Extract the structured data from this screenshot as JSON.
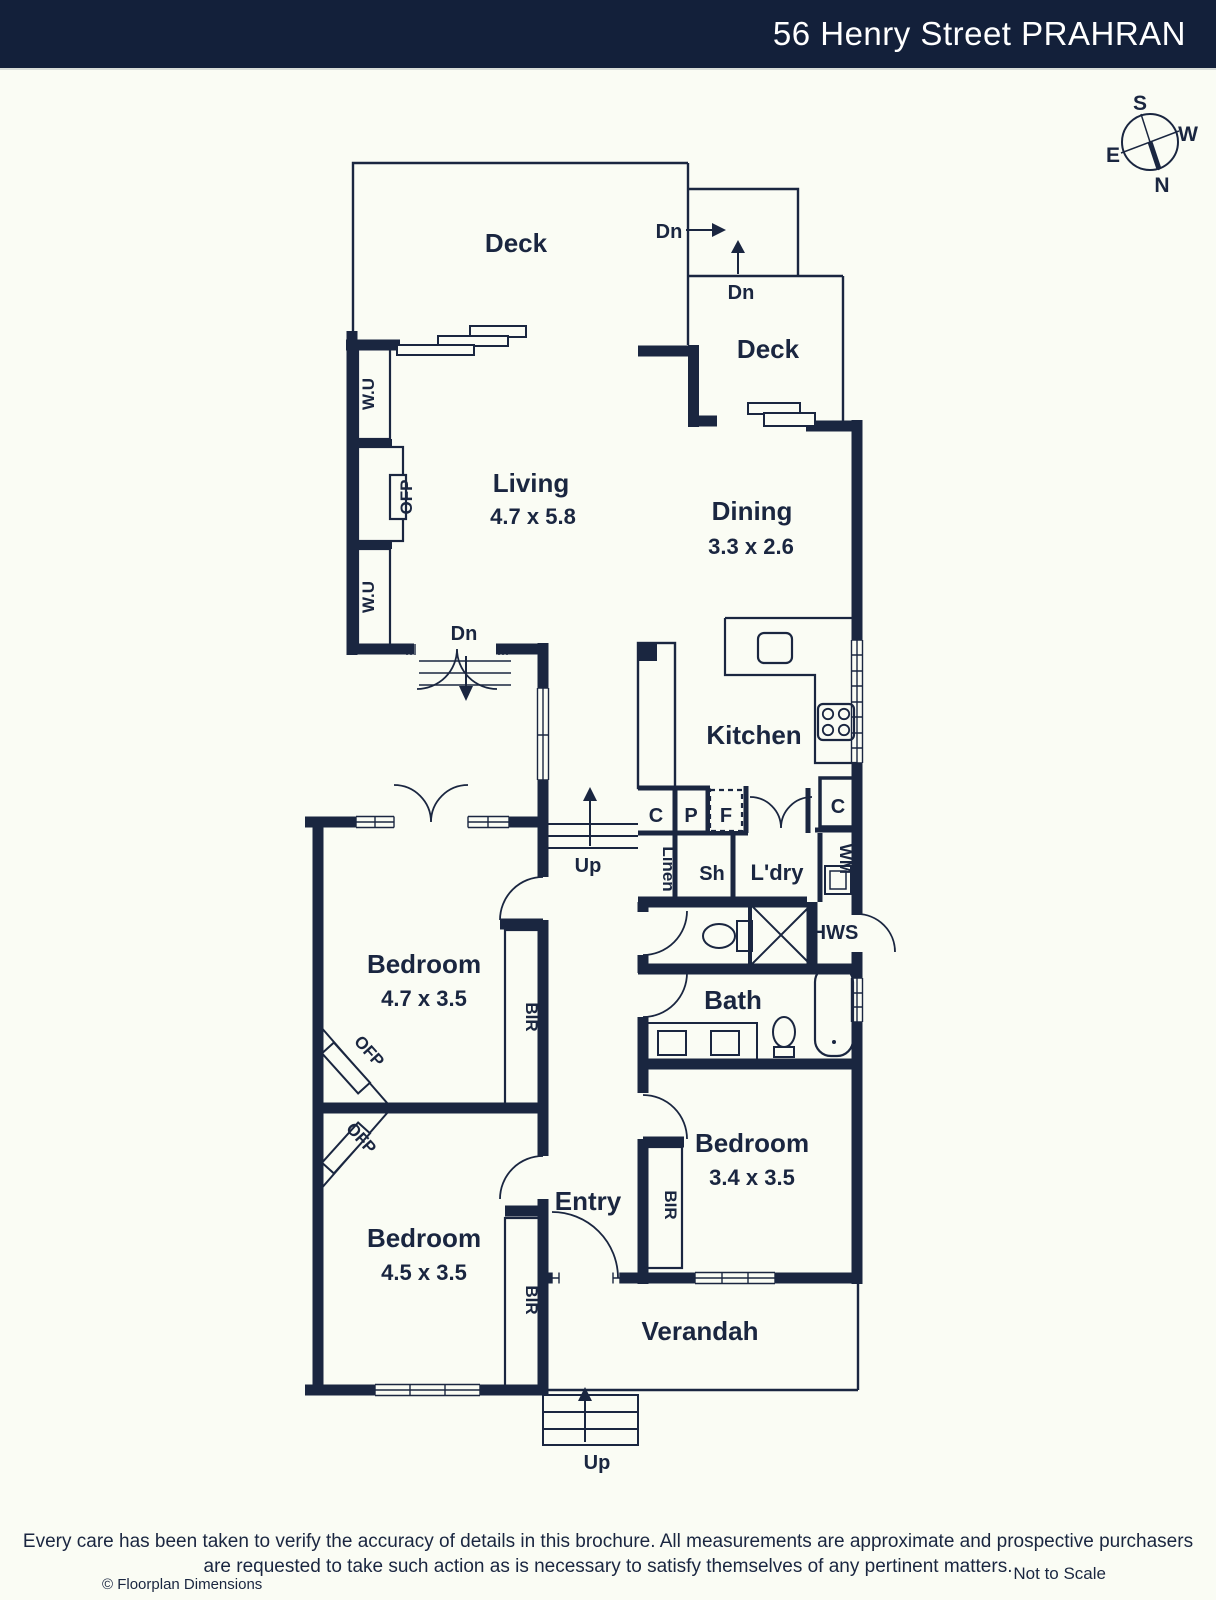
{
  "header": {
    "title": "56 Henry Street PRAHRAN"
  },
  "compass": {
    "n": "N",
    "s": "S",
    "e": "E",
    "w": "W"
  },
  "colors": {
    "ink": "#1a2640",
    "header_bg": "#13203a",
    "page_bg": "#fafcf4"
  },
  "rooms": {
    "deck_top": {
      "name": "Deck"
    },
    "deck_side": {
      "name": "Deck"
    },
    "living": {
      "name": "Living",
      "dims": "4.7 x 5.8"
    },
    "dining": {
      "name": "Dining",
      "dims": "3.3 x 2.6"
    },
    "kitchen": {
      "name": "Kitchen"
    },
    "laundry": {
      "name": "L'dry"
    },
    "bath": {
      "name": "Bath"
    },
    "bedroom_main": {
      "name": "Bedroom",
      "dims": "4.7 x 3.5"
    },
    "bedroom_rear": {
      "name": "Bedroom",
      "dims": "3.4 x 3.5"
    },
    "bedroom_front": {
      "name": "Bedroom",
      "dims": "4.5 x 3.5"
    },
    "entry": {
      "name": "Entry"
    },
    "verandah": {
      "name": "Verandah"
    }
  },
  "labels": {
    "dn": "Dn",
    "up": "Up",
    "wu": "W.U",
    "ofp": "OFP",
    "bir": "BIR",
    "cupboard": "C",
    "pantry": "P",
    "fridge": "F",
    "linen": "Linen",
    "shower": "Sh",
    "washer": "WM",
    "hws": "HWS"
  },
  "footer": {
    "disclaimer_line1": "Every care has been taken to verify the accuracy of details in this brochure. All measurements are approximate and prospective purchasers",
    "disclaimer_line2": "are requested to take such action as is necessary to satisfy themselves of any pertinent matters.",
    "credit": "© Floorplan Dimensions",
    "scale_note": "Not to Scale"
  }
}
